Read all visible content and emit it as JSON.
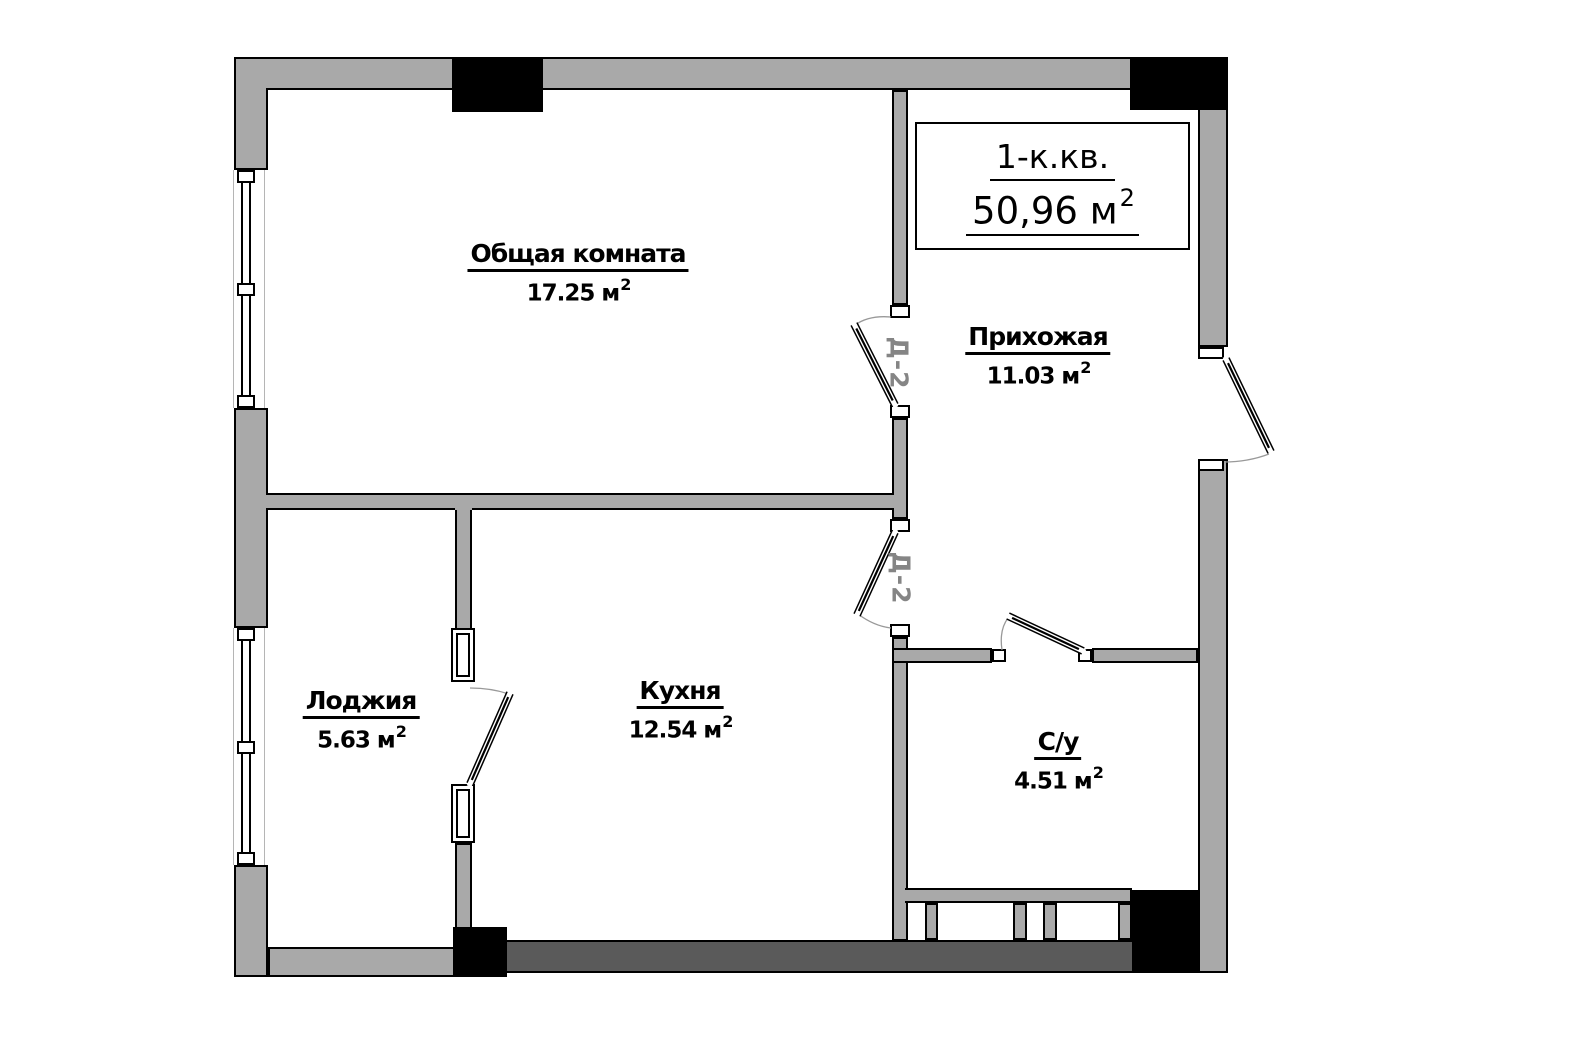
{
  "title_box": {
    "apartment_type": "1-к.кв.",
    "total_area_base": "50,96 м",
    "total_area_sup": "2"
  },
  "rooms": [
    {
      "name": "Общая комната",
      "area_base": "17.25 м",
      "area_sup": "2"
    },
    {
      "name": "Прихожая",
      "area_base": "11.03 м",
      "area_sup": "2"
    },
    {
      "name": "Лоджия",
      "area_base": "5.63 м",
      "area_sup": "2"
    },
    {
      "name": "Кухня",
      "area_base": "12.54 м",
      "area_sup": "2"
    },
    {
      "name": "С/у",
      "area_base": "4.51 м",
      "area_sup": "2"
    }
  ],
  "door_marks": [
    "Д-2",
    "Д-2"
  ],
  "colors": {
    "wall": "#a9a9a9",
    "dark_wall": "#5a5a5a",
    "column": "#000000",
    "outline": "#000000",
    "swing_arc": "#999999",
    "door_mark_text": "#858585",
    "background": "#ffffff"
  }
}
